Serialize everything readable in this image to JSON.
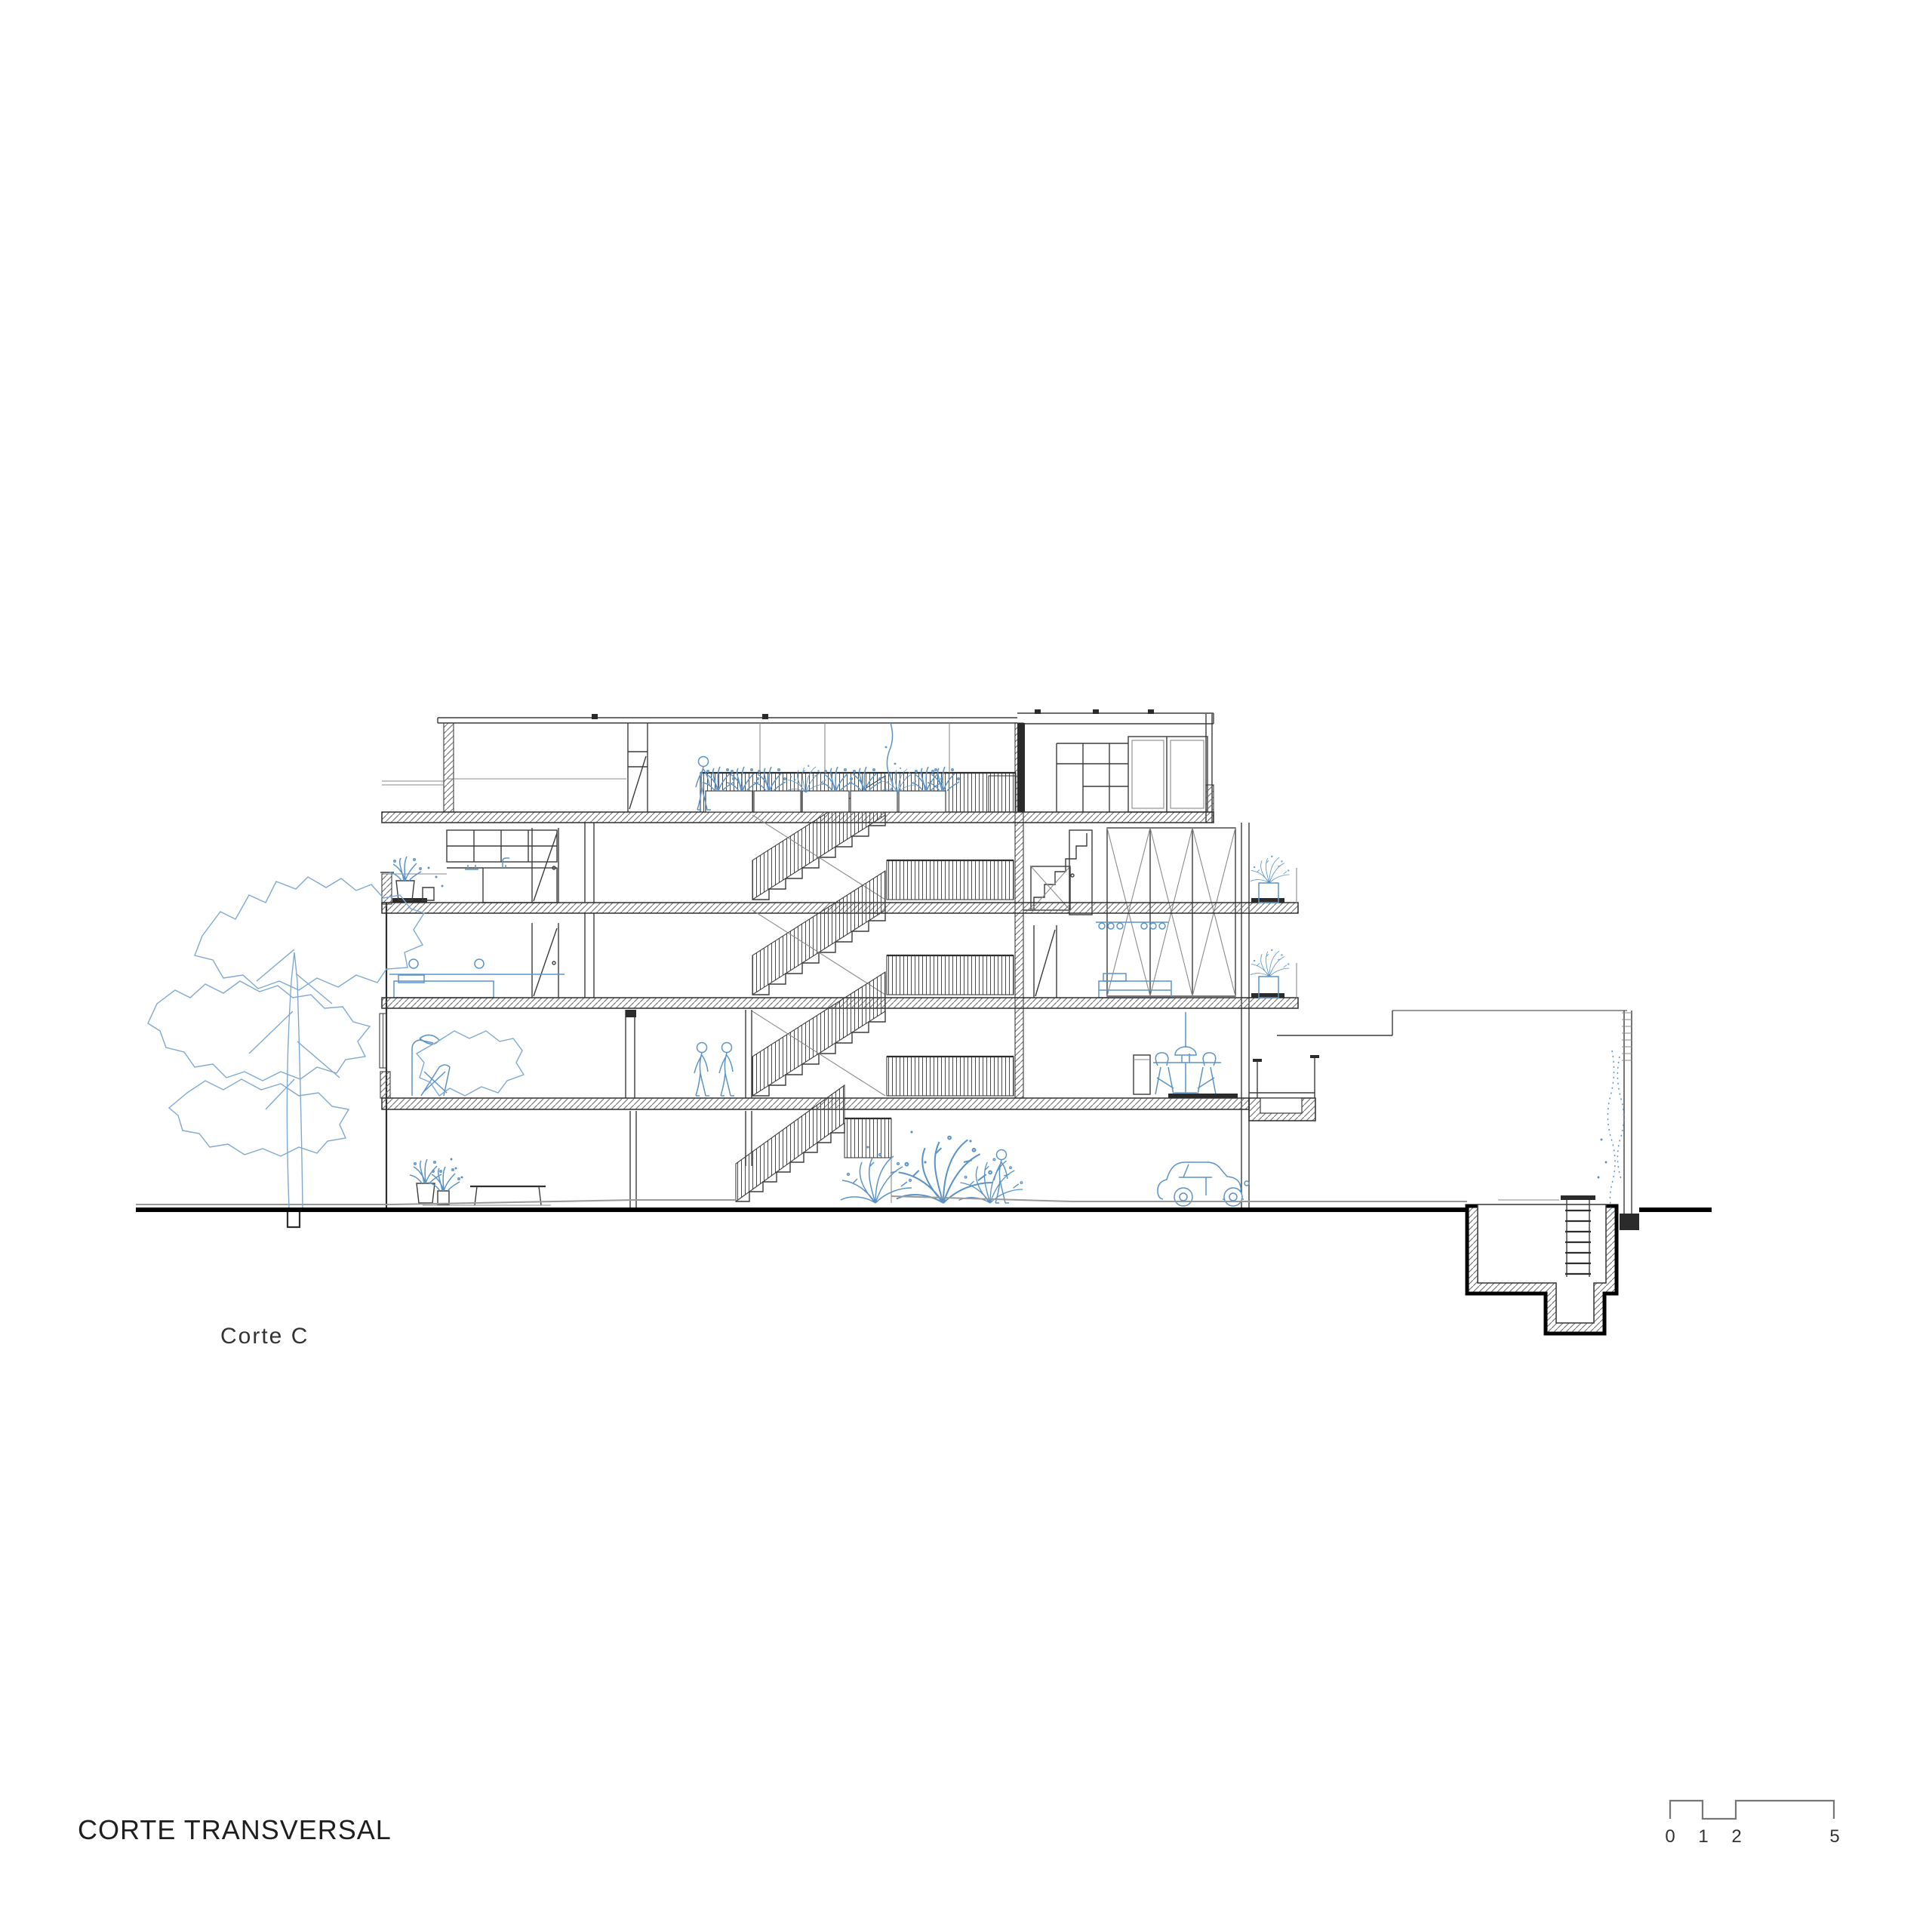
{
  "sheet": {
    "background": "#ffffff"
  },
  "annotations": {
    "section_label": "Corte C",
    "sheet_title": "CORTE TRANSVERSAL"
  },
  "scale_bar": {
    "tick_labels": [
      "0",
      "1",
      "2",
      "5"
    ]
  },
  "palette": {
    "ink": "#3c3c3c",
    "line_gray": "#8a8a8a",
    "accent_blue": "#5b93c8",
    "tree_blue": "#7fa9d2",
    "ground_black": "#000000"
  },
  "drawing": {
    "kind": "building cross-section",
    "levels_visible": 5,
    "features": [
      "large tree",
      "roof terrace planters",
      "open switchback stairs with guardrails",
      "kitchen casework",
      "beds and dining furniture",
      "parked car",
      "pedestrians",
      "garden shrubs",
      "basement cistern with ladder",
      "parking canopy and boundary wall"
    ]
  }
}
